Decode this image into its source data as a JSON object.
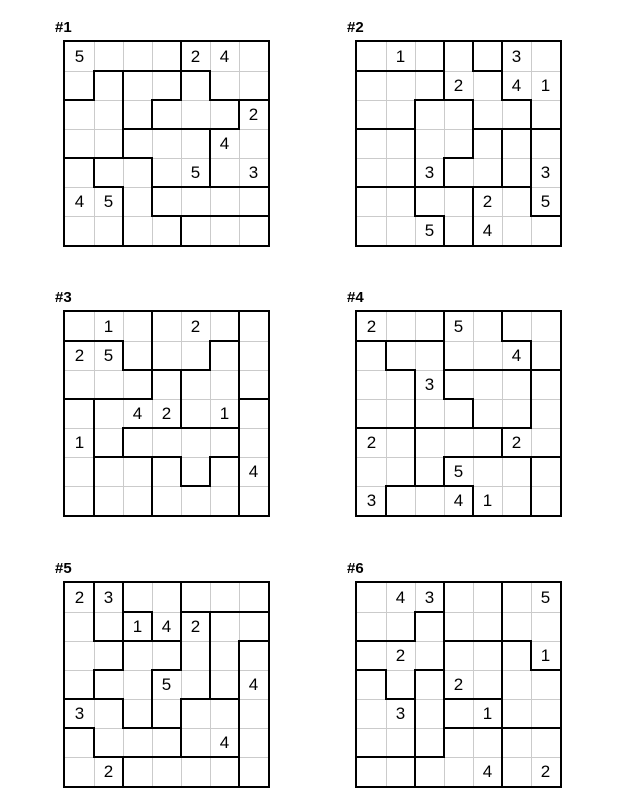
{
  "sheet": {
    "puzzle_type": "suguru-tectonic",
    "grid_rows": 7,
    "grid_cols": 7,
    "colors": {
      "thick_border": "#000000",
      "thin_grid": "#cbcbcb",
      "digit": "#000000",
      "background": "#ffffff"
    }
  },
  "puzzles": [
    {
      "label": "#1",
      "regions": [
        "AAAABBB",
        "ACDDEBB",
        "CCDEEEG",
        "CCFFFGG",
        "IJJFFGG",
        "IIJLLLL",
        "IIJJMMM"
      ],
      "givens": [
        [
          1,
          1,
          "5"
        ],
        [
          1,
          5,
          "2"
        ],
        [
          1,
          6,
          "4"
        ],
        [
          3,
          7,
          "2"
        ],
        [
          4,
          6,
          "4"
        ],
        [
          5,
          5,
          "5"
        ],
        [
          5,
          7,
          "3"
        ],
        [
          6,
          1,
          "4"
        ],
        [
          6,
          2,
          "5"
        ]
      ]
    },
    {
      "label": "#2",
      "regions": [
        "aaabcdd",
        "eeebbdd",
        "eeffbbd",
        "ggffhij",
        "ggfhhij",
        "kkllmmj",
        "kkklmmm"
      ],
      "givens": [
        [
          1,
          2,
          "1"
        ],
        [
          1,
          6,
          "3"
        ],
        [
          2,
          4,
          "2"
        ],
        [
          2,
          6,
          "4"
        ],
        [
          2,
          7,
          "1"
        ],
        [
          5,
          3,
          "3"
        ],
        [
          5,
          7,
          "3"
        ],
        [
          6,
          5,
          "2"
        ],
        [
          6,
          7,
          "5"
        ],
        [
          7,
          3,
          "5"
        ],
        [
          7,
          5,
          "4"
        ]
      ]
    },
    {
      "label": "#3",
      "regions": [
        "AAACCCK",
        "BBACCDK",
        "BBBFDDK",
        "GFFFDDR",
        "GFHHHHR",
        "GIIJHJR",
        "GIIJJJR"
      ],
      "givens": [
        [
          1,
          2,
          "1"
        ],
        [
          1,
          5,
          "2"
        ],
        [
          2,
          1,
          "2"
        ],
        [
          2,
          2,
          "5"
        ],
        [
          4,
          3,
          "4"
        ],
        [
          4,
          4,
          "2"
        ],
        [
          4,
          6,
          "1"
        ],
        [
          5,
          1,
          "1"
        ],
        [
          6,
          7,
          "4"
        ]
      ]
    },
    {
      "label": "#4",
      "regions": [
        "AAABBCC",
        "DEEBBBC",
        "DDEFFFG",
        "DDEEFFG",
        "HHIIIGG",
        "HHIJJJL",
        "HKKKJJL"
      ],
      "givens": [
        [
          1,
          1,
          "2"
        ],
        [
          1,
          4,
          "5"
        ],
        [
          2,
          6,
          "4"
        ],
        [
          3,
          3,
          "3"
        ],
        [
          5,
          1,
          "2"
        ],
        [
          5,
          6,
          "2"
        ],
        [
          6,
          4,
          "5"
        ],
        [
          7,
          1,
          "3"
        ],
        [
          7,
          4,
          "4"
        ],
        [
          7,
          5,
          "1"
        ]
      ]
    },
    {
      "label": "#5",
      "regions": [
        "ABCCDDD",
        "ABECGHH",
        "AAJJGHI",
        "AJJGGHI",
        "MMJGKKI",
        "NMMMKKI",
        "NNOOOOI"
      ],
      "givens": [
        [
          1,
          1,
          "2"
        ],
        [
          1,
          2,
          "3"
        ],
        [
          2,
          3,
          "1"
        ],
        [
          2,
          4,
          "4"
        ],
        [
          2,
          5,
          "2"
        ],
        [
          4,
          4,
          "5"
        ],
        [
          4,
          7,
          "4"
        ],
        [
          5,
          1,
          "3"
        ],
        [
          6,
          6,
          "4"
        ],
        [
          7,
          2,
          "2"
        ]
      ]
    },
    {
      "label": "#6",
      "regions": [
        "AAABBCC",
        "AADBBCC",
        "DDDEEFC",
        "GDHEEFF",
        "GGHIIFF",
        "GGHKKLL",
        "JJKKKLL"
      ],
      "givens": [
        [
          1,
          2,
          "4"
        ],
        [
          1,
          3,
          "3"
        ],
        [
          1,
          7,
          "5"
        ],
        [
          3,
          2,
          "2"
        ],
        [
          3,
          7,
          "1"
        ],
        [
          4,
          4,
          "2"
        ],
        [
          5,
          2,
          "3"
        ],
        [
          5,
          5,
          "1"
        ],
        [
          7,
          5,
          "4"
        ],
        [
          7,
          7,
          "2"
        ]
      ]
    }
  ]
}
